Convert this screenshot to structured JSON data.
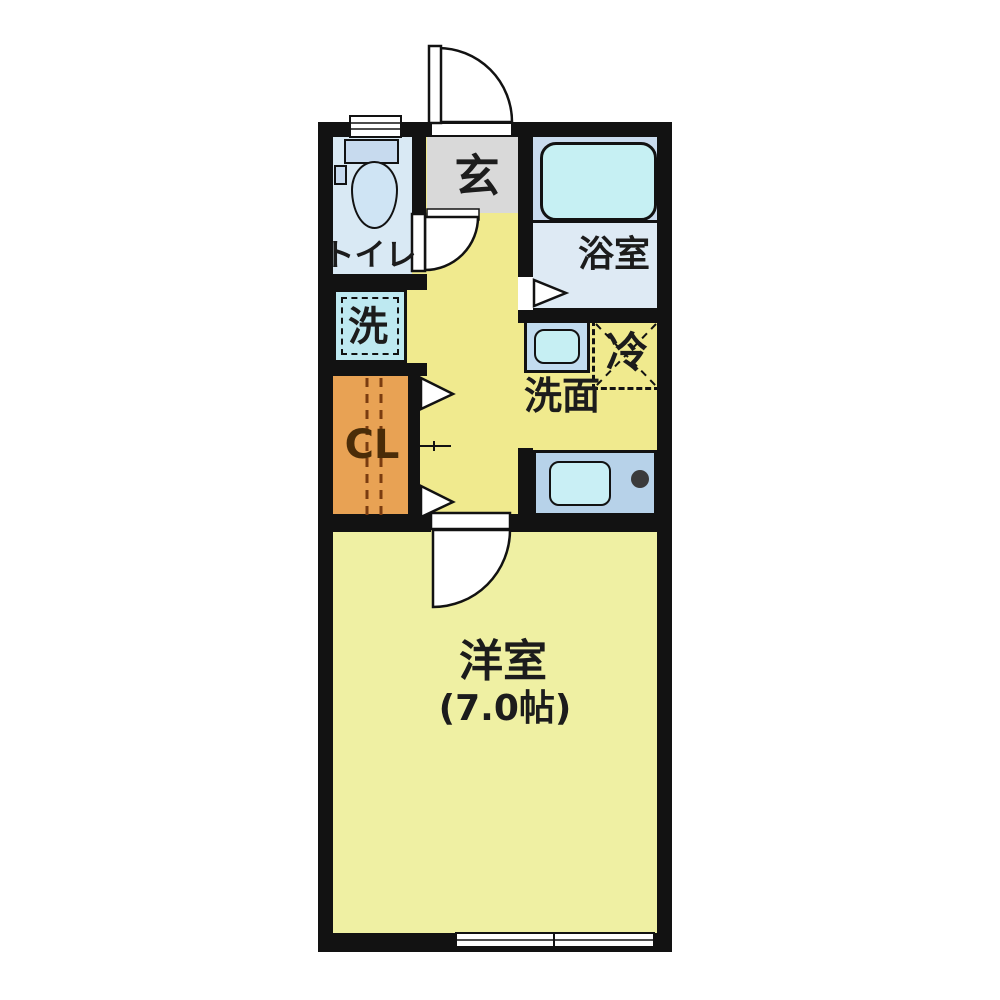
{
  "plan": {
    "type": "japanese-apartment-floor-plan",
    "rooms": {
      "entrance_label": "玄",
      "toilet_label": "トイレ",
      "bath_label": "浴室",
      "washer_label": "洗",
      "closet_label": "CL",
      "washroom_label": "洗面",
      "fridge_label": "冷",
      "main_room_label": "洋室",
      "main_room_size": "(7.0帖)"
    },
    "colors": {
      "wall": "#121212",
      "hallway_floor": "#F0EA8E",
      "main_room_floor": "#EFF0A3",
      "entrance_floor": "#D9D9D9",
      "toilet_floor": "#D9E9F4",
      "bath_upper_floor": "#C9DBEE",
      "bath_lower_floor": "#DEEAF4",
      "closet": "#E8A254",
      "tub_cyan": "#C6F0F3",
      "counter_blue": "#B7D2E9"
    }
  }
}
